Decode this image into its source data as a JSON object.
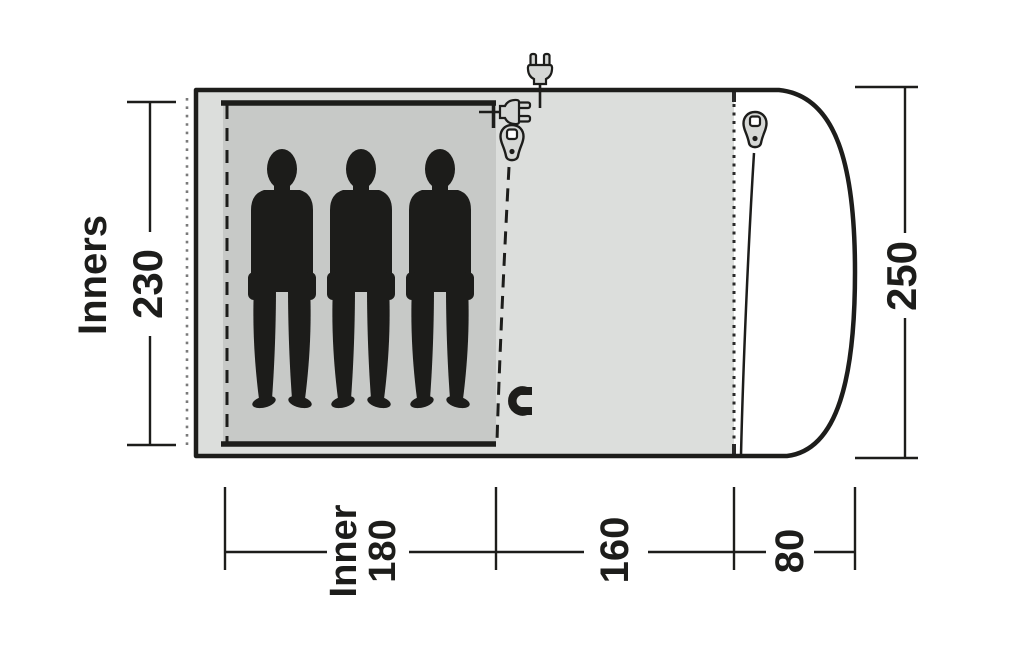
{
  "diagram": {
    "side_label": "Inners",
    "dim_inner_width": "230",
    "dim_total_width": "250",
    "dim_inner_length_line1": "Inner",
    "dim_inner_length_line2": "180",
    "dim_living_length": "160",
    "dim_porch_depth": "80",
    "occupant_count": 3,
    "icons": [
      "power-plug-top-icon",
      "power-plug-entry-icon",
      "zipper-pull-inner-door-icon",
      "zipper-pull-front-door-icon",
      "magnet-closure-icon"
    ],
    "colors": {
      "tent_body": "#dcdedc",
      "inner_tent": "#c7c9c7",
      "outline": "#1d1d1b",
      "icon_fill": "#d5d7d5",
      "background": "#ffffff"
    }
  }
}
